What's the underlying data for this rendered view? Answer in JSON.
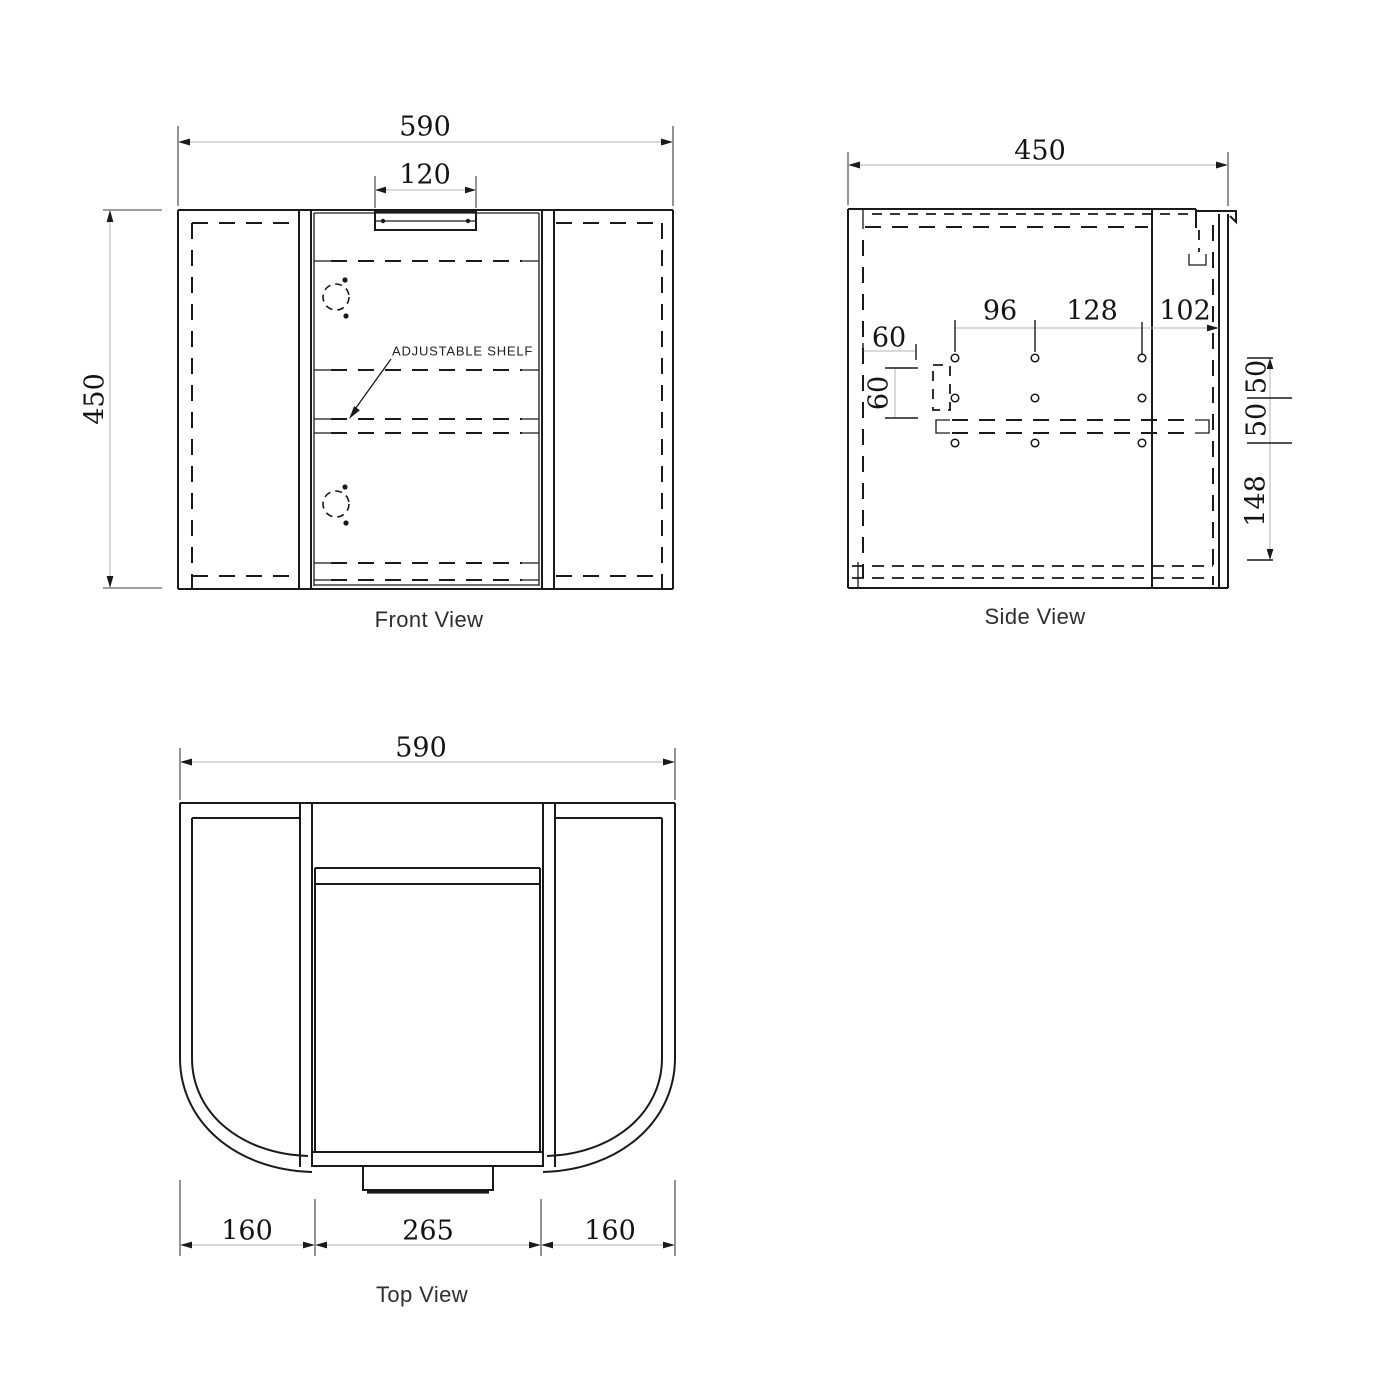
{
  "front_view": {
    "label": "Front View",
    "annotation": "ADJUSTABLE SHELF",
    "dims": {
      "overall_width": "590",
      "handle_width": "120",
      "overall_height": "450"
    }
  },
  "side_view": {
    "label": "Side View",
    "dims": {
      "overall_depth": "450",
      "hole_span_1": "96",
      "hole_span_2": "128",
      "hole_span_3": "102",
      "front_inset": "60",
      "pin_block_height": "60",
      "row_gap_top": "50",
      "row_gap_bottom": "50",
      "bottom_clearance": "148"
    }
  },
  "top_view": {
    "label": "Top View",
    "dims": {
      "overall_width": "590",
      "left_panel": "160",
      "door_width": "265",
      "right_panel": "160"
    }
  },
  "colors": {
    "object_line": "#1a1a1a",
    "dim_line": "#b3b3b3",
    "text": "#141414",
    "background": "#ffffff"
  }
}
